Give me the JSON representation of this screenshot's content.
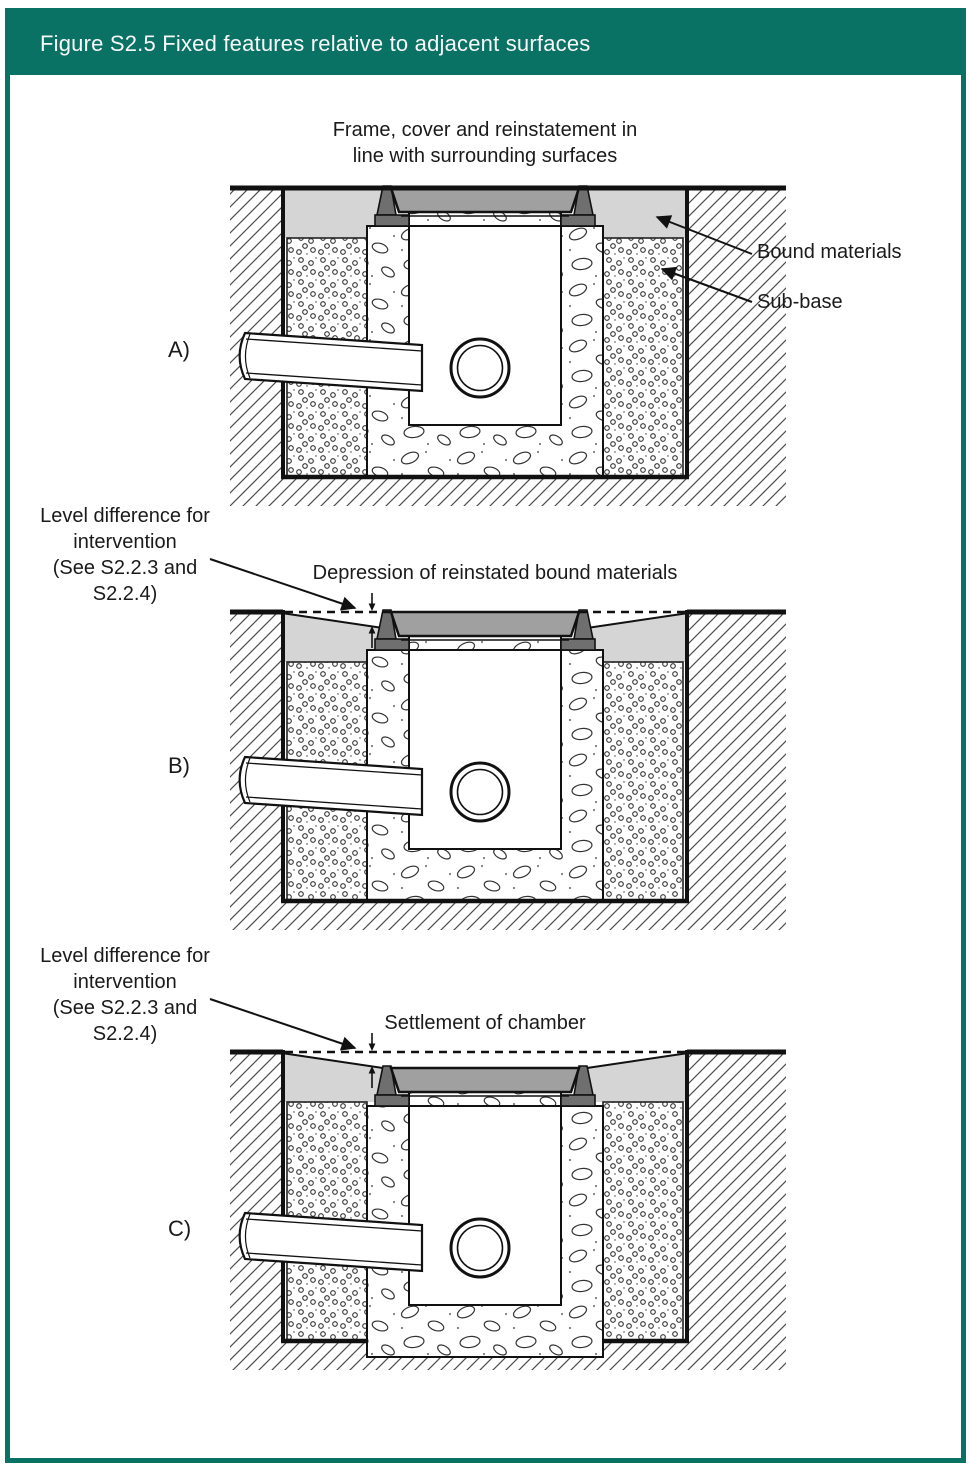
{
  "figure": {
    "title": "Figure S2.5 Fixed features relative to adjacent surfaces"
  },
  "diagram_a": {
    "label": "A)",
    "caption_lines": [
      "Frame, cover and reinstatement in",
      "line with surrounding surfaces"
    ],
    "callout_bound_materials": "Bound materials",
    "callout_sub_base": "Sub-base"
  },
  "diagram_b": {
    "label": "B)",
    "level_note_lines": [
      "Level difference for",
      "intervention",
      "(See S2.2.3 and",
      "S2.2.4)"
    ],
    "caption": "Depression of reinstated bound materials"
  },
  "diagram_c": {
    "label": "C)",
    "level_note_lines": [
      "Level difference for",
      "intervention",
      "(See S2.2.3 and",
      "S2.2.4)"
    ],
    "caption": "Settlement of chamber"
  },
  "colors": {
    "header_green": "#0a7165",
    "bound_materials_gray": "#d5d5d5",
    "cover_gray": "#a0a0a0",
    "frame_dark_gray": "#6f6f6f",
    "line_black": "#111111"
  }
}
